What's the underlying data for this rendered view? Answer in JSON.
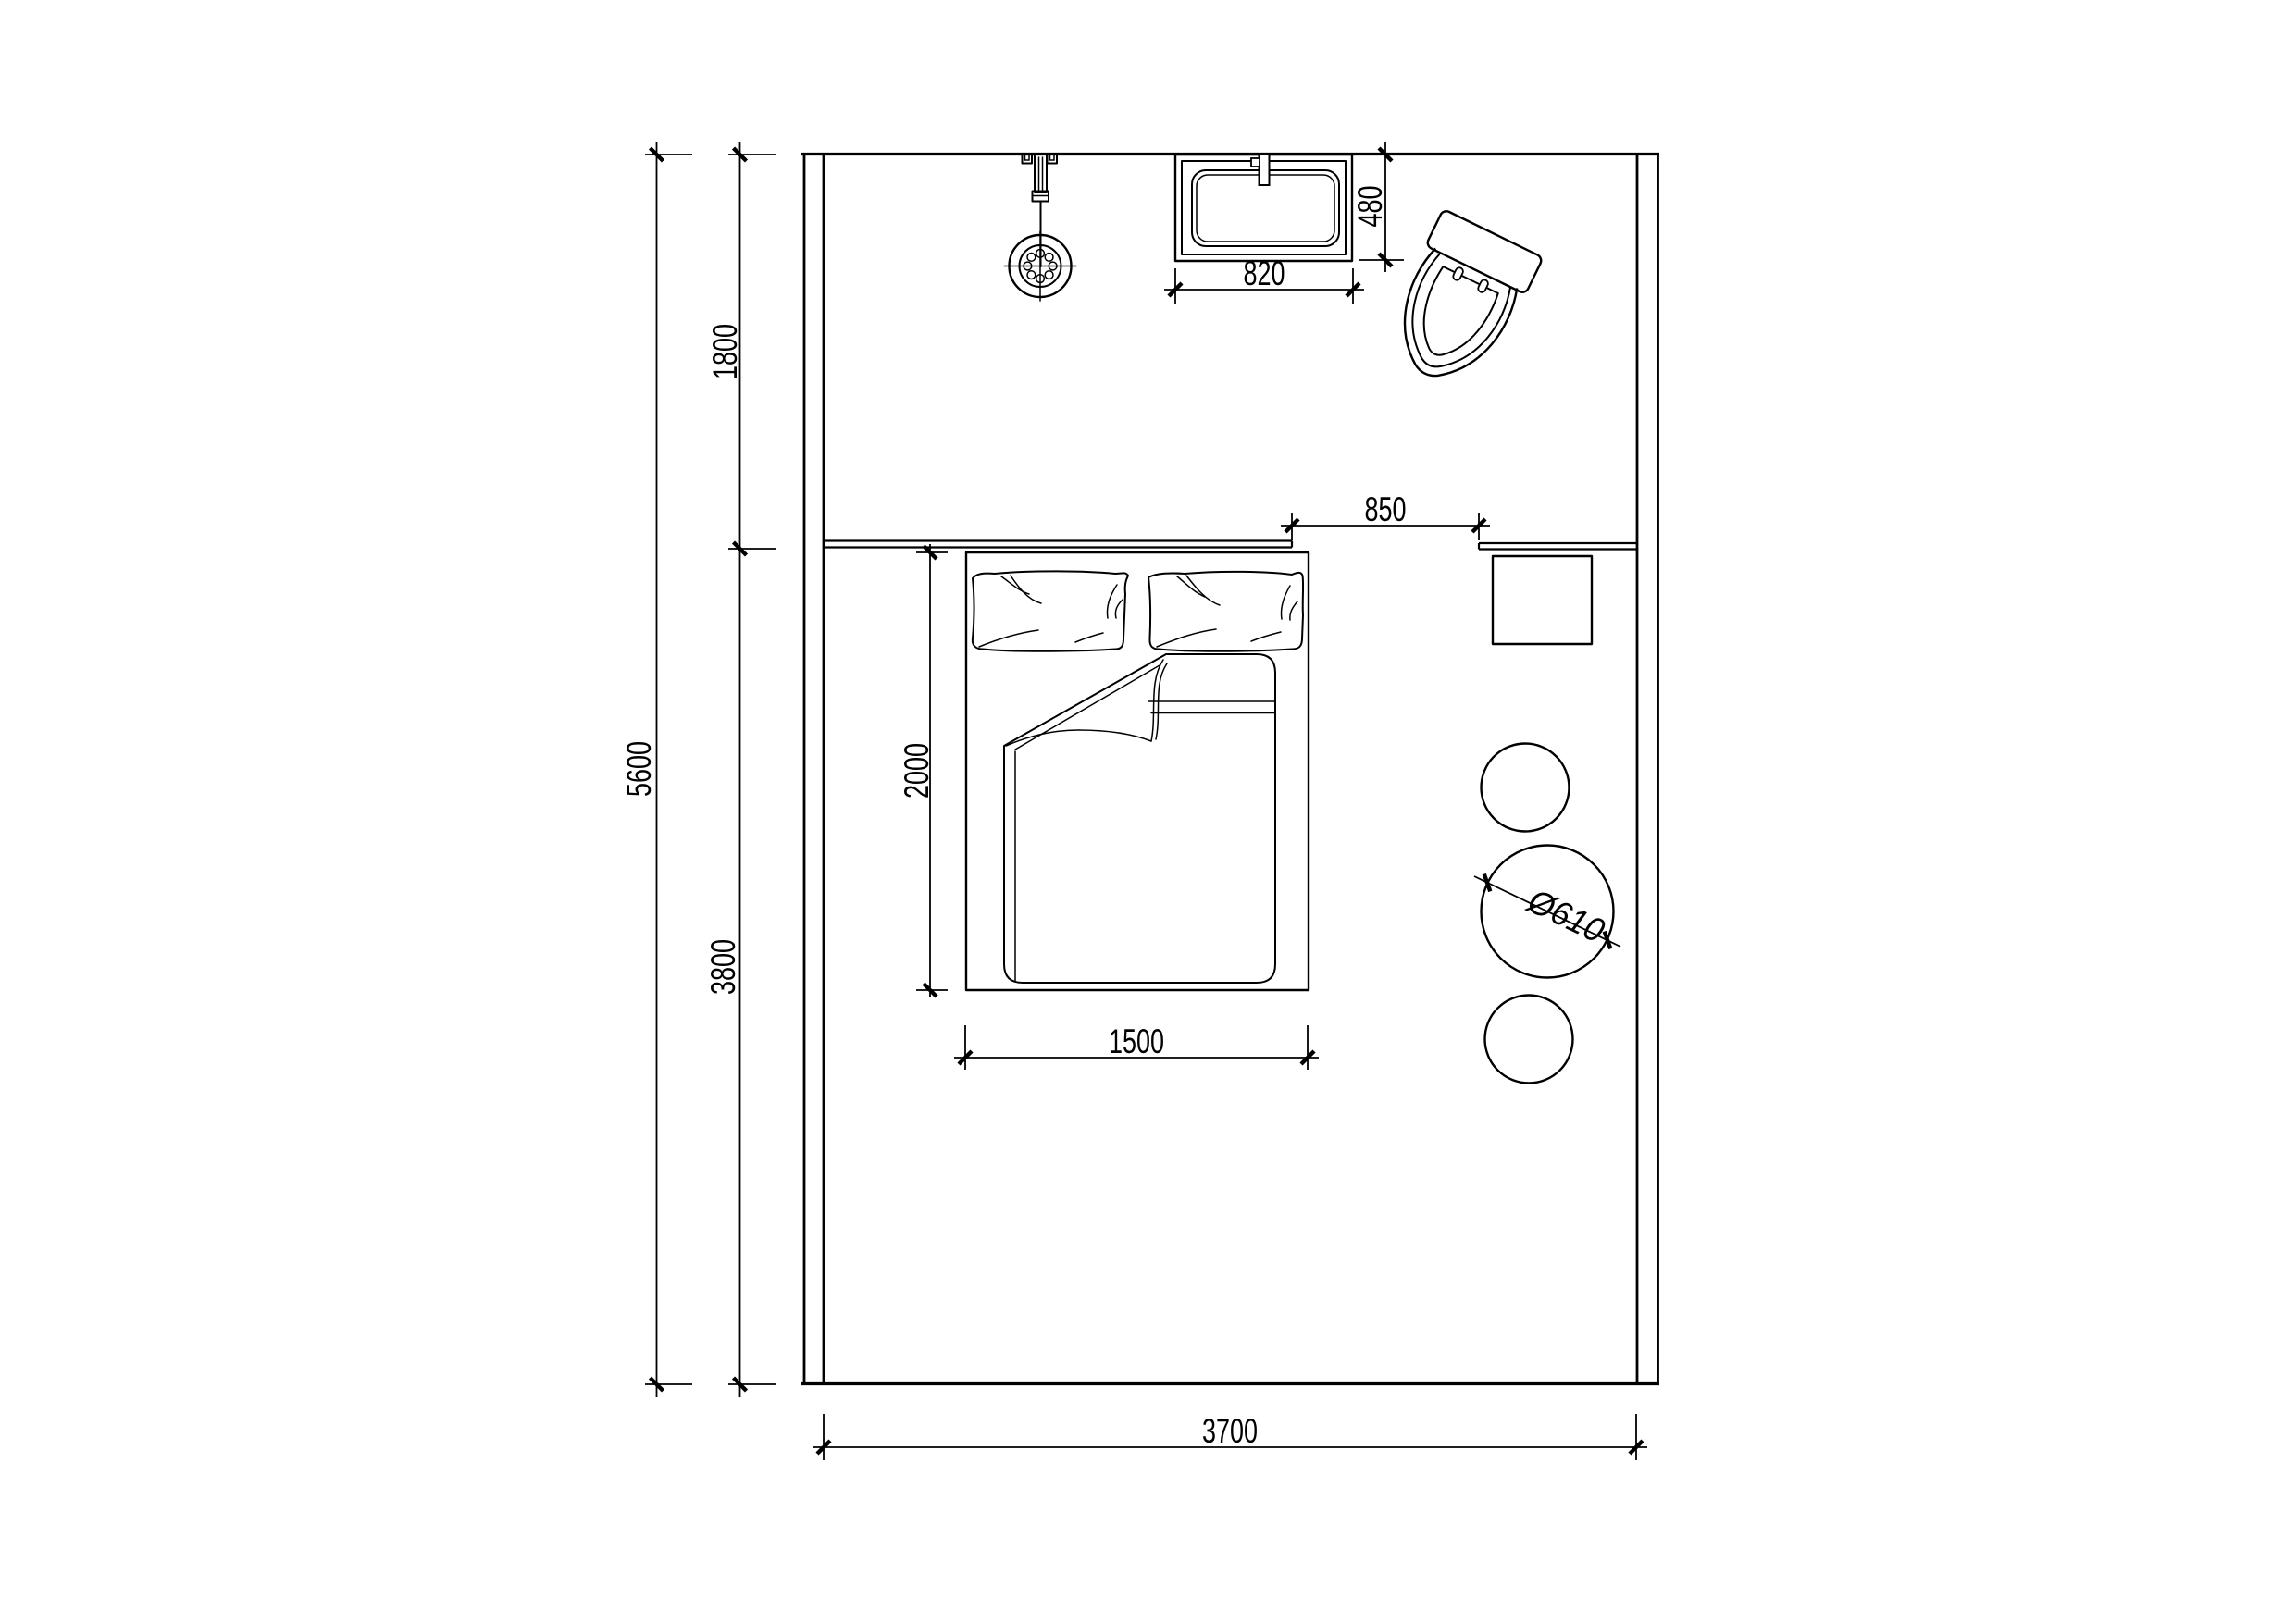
{
  "drawing": {
    "kind": "bedroom-floor-plan",
    "background_color": "#ffffff",
    "line_color": "#000000"
  },
  "dims": {
    "total_depth": "5600",
    "bath_zone_depth": "1800",
    "bedroom_zone_depth": "3800",
    "room_width": "3700",
    "bed_length": "2000",
    "bed_width": "1500",
    "opening_width": "850",
    "basin_width": "820",
    "basin_depth": "480",
    "table_diameter": "Ø610"
  },
  "symbols": {
    "shower": "shower-head-symbol",
    "basin": "wash-basin-symbol",
    "toilet": "toilet-symbol",
    "bed": "double-bed-symbol",
    "pillows": "pillow-symbol",
    "duvet": "duvet-fold-symbol",
    "nightstand": "nightstand-symbol",
    "table": "round-table-symbol",
    "stool": "round-stool-symbol"
  }
}
